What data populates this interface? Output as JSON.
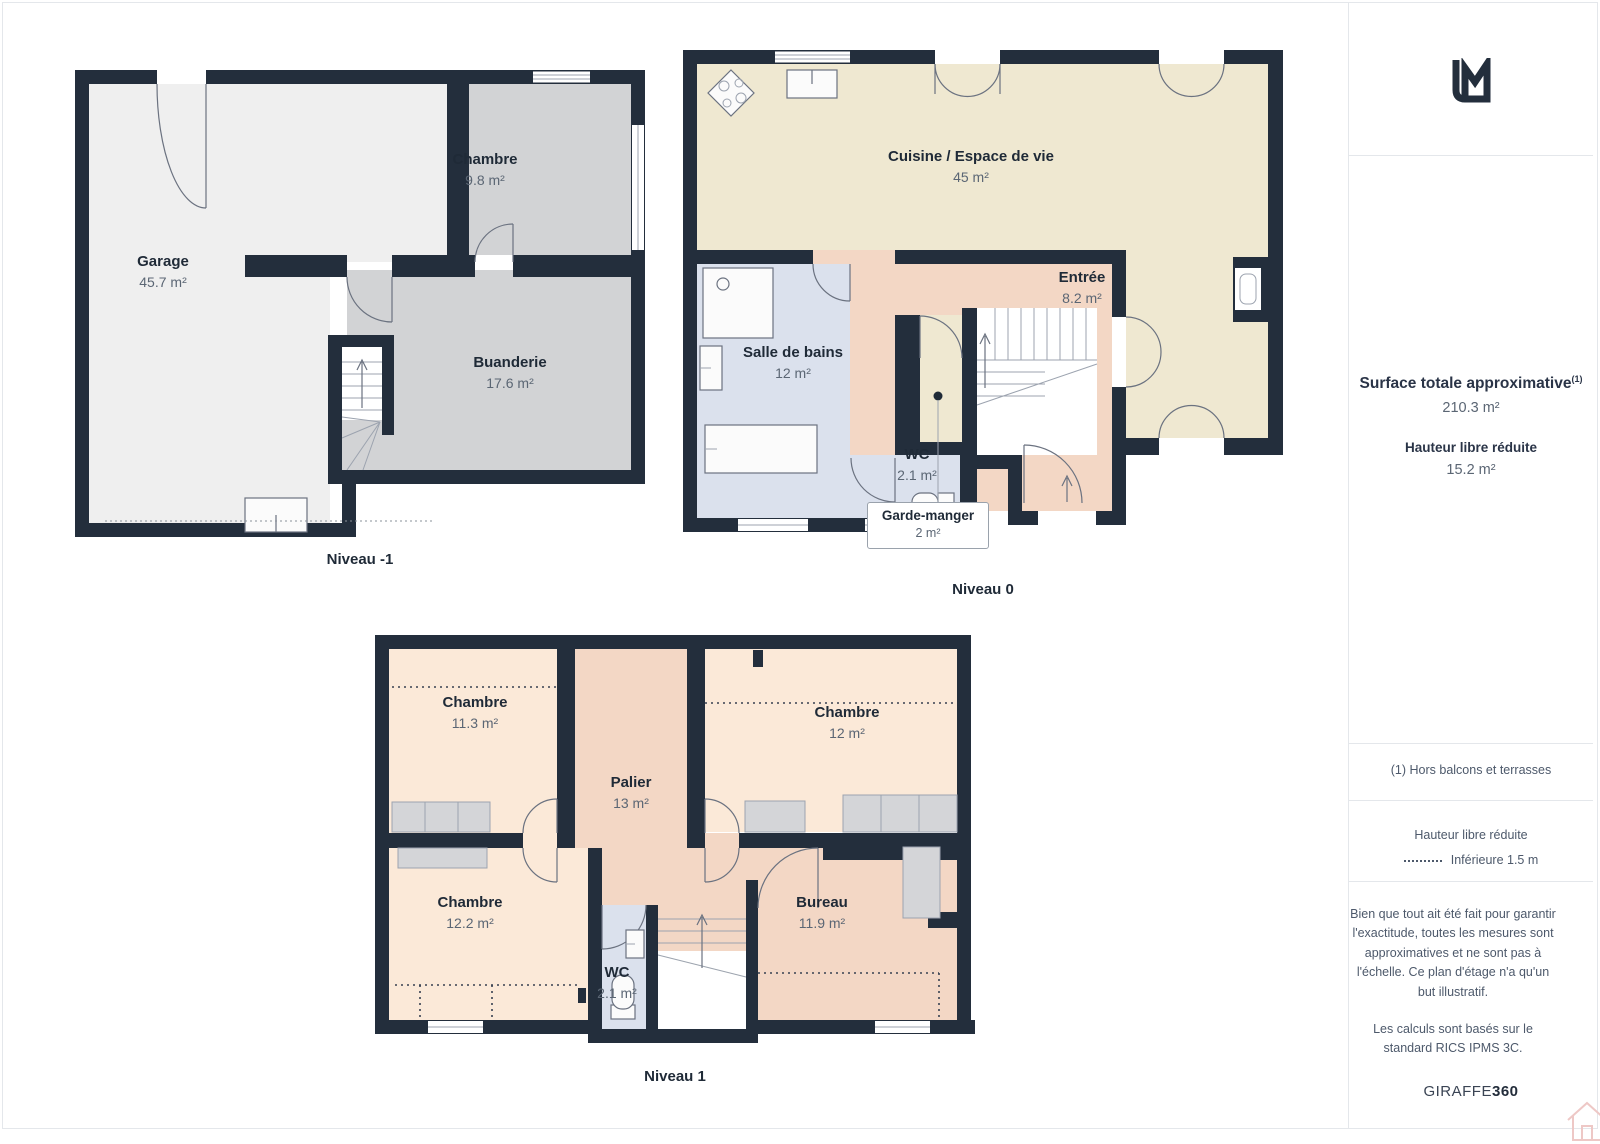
{
  "palette": {
    "wall": "#232E3C",
    "floor_light": "#EFEFEF",
    "floor_gray": "#D2D3D5",
    "floor_beige": "#EFE8D1",
    "floor_pink": "#F3D7C5",
    "floor_peach": "#FBE9D8",
    "floor_blue": "#DBE1ED",
    "text_dark": "#1F2A37",
    "text_gray": "#5B6674",
    "divider": "#E4E7EB",
    "watermark_pink": "#EEC8C6"
  },
  "floors": [
    {
      "id": "niveau-m1",
      "caption": "Niveau -1",
      "rooms": [
        {
          "name": "Garage",
          "area": "45.7 m²"
        },
        {
          "name": "Chambre",
          "area": "9.8 m²"
        },
        {
          "name": "Buanderie",
          "area": "17.6 m²"
        }
      ]
    },
    {
      "id": "niveau-0",
      "caption": "Niveau 0",
      "rooms": [
        {
          "name": "Cuisine / Espace de vie",
          "area": "45 m²"
        },
        {
          "name": "Entrée",
          "area": "8.2 m²"
        },
        {
          "name": "Salle de bains",
          "area": "12 m²"
        },
        {
          "name": "WC",
          "area": "2.1 m²"
        }
      ],
      "callout": {
        "name": "Garde-manger",
        "area": "2 m²"
      }
    },
    {
      "id": "niveau-1",
      "caption": "Niveau 1",
      "rooms": [
        {
          "name": "Chambre",
          "area": "11.3 m²"
        },
        {
          "name": "Chambre",
          "area": "12 m²"
        },
        {
          "name": "Palier",
          "area": "13 m²"
        },
        {
          "name": "Chambre",
          "area": "12.2 m²"
        },
        {
          "name": "Bureau",
          "area": "11.9 m²"
        },
        {
          "name": "WC",
          "area": "2.1 m²"
        }
      ]
    }
  ],
  "sidebar": {
    "summary_title": "Surface totale approximative",
    "summary_sup": "(1)",
    "summary_value": "210.3 m²",
    "height_title": "Hauteur libre réduite",
    "height_value": "15.2 m²",
    "footnote": "(1) Hors balcons et terrasses",
    "legend_title": "Hauteur libre réduite",
    "legend_value": "Inférieure 1.5 m",
    "disclaimer1": "Bien que tout ait été fait pour garantir l'exactitude, toutes les mesures sont approximatives et ne sont pas à l'échelle. Ce plan d'étage n'a qu'un but illustratif.",
    "disclaimer2": "Les calculs sont basés sur le standard RICS IPMS 3C.",
    "brand": "GIRAFFE",
    "brand_bold": "360"
  }
}
